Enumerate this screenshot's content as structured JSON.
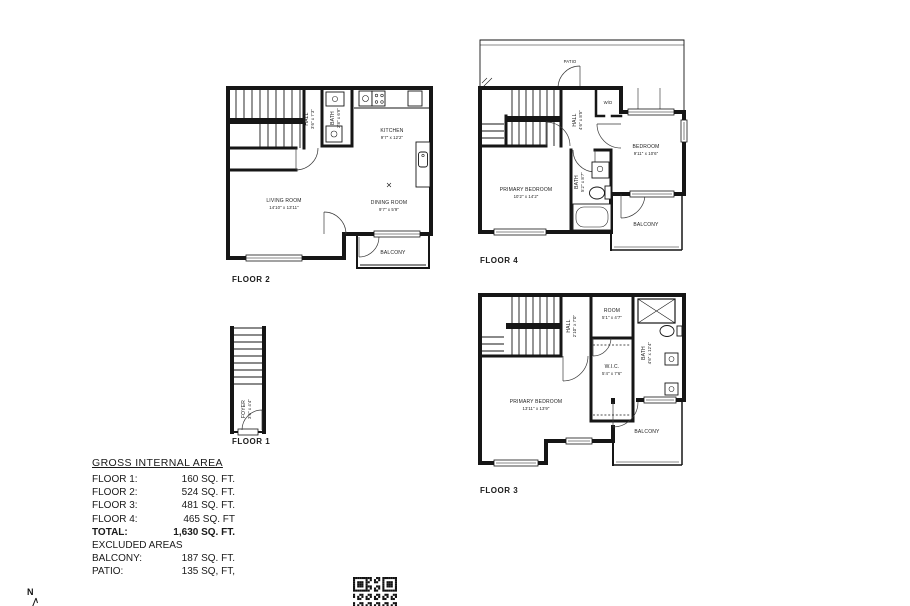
{
  "compass": {
    "label": "N"
  },
  "floors": {
    "floor1": {
      "label": "FLOOR 1",
      "rooms": {
        "foyer": {
          "name": "FOYER",
          "dims": "3'6\" x 4'4\""
        }
      }
    },
    "floor2": {
      "label": "FLOOR 2",
      "rooms": {
        "hall": {
          "name": "HALL",
          "dims": "3'6\" x 7'3\""
        },
        "bath": {
          "name": "BATH",
          "dims": "2'8\" x 6'9\""
        },
        "kitchen": {
          "name": "KITCHEN",
          "dims": "9'7\" x 12'2\""
        },
        "living_room": {
          "name": "LIVING ROOM",
          "dims": "14'10\" x 13'11\""
        },
        "dining_room": {
          "name": "DINING ROOM",
          "dims": "9'7\" x 5'9\""
        },
        "balcony": {
          "name": "BALCONY"
        }
      }
    },
    "floor3": {
      "label": "FLOOR 3",
      "rooms": {
        "hall": {
          "name": "HALL",
          "dims": "2'10\" x 7'0\""
        },
        "room": {
          "name": "ROOM",
          "dims": "5'1\" x 4'7\""
        },
        "bath": {
          "name": "BATH",
          "dims": "4'6\" x 12'4\""
        },
        "wic": {
          "name": "W.I.C.",
          "dims": "5'4\" x 7'6\""
        },
        "primary_bedroom": {
          "name": "PRIMARY BEDROOM",
          "dims": "13'11\" x 13'9\""
        },
        "balcony": {
          "name": "BALCONY"
        }
      }
    },
    "floor4": {
      "label": "FLOOR 4",
      "rooms": {
        "patio": {
          "name": "PATIO"
        },
        "hall": {
          "name": "HALL",
          "dims": "4'6\" x 8'5\""
        },
        "wd": {
          "name": "W/D"
        },
        "bedroom": {
          "name": "BEDROOM",
          "dims": "9'11\" x 10'6\""
        },
        "primary_bedroom": {
          "name": "PRIMARY BEDROOM",
          "dims": "10'2\" x 14'2\""
        },
        "bath": {
          "name": "BATH",
          "dims": "5'2\" x 8'7\""
        },
        "balcony": {
          "name": "BALCONY"
        }
      }
    }
  },
  "area_table": {
    "title": "GROSS INTERNAL AREA",
    "rows": [
      {
        "label": "FLOOR 1:",
        "value": "160 SQ. FT."
      },
      {
        "label": "FLOOR 2:",
        "value": "524 SQ. FT."
      },
      {
        "label": "FLOOR 3:",
        "value": "481 SQ. FT."
      },
      {
        "label": "FLOOR 4:",
        "value": "465 SQ. FT"
      },
      {
        "label": "TOTAL:",
        "value": "1,630 SQ. FT."
      }
    ],
    "excluded_title": "EXCLUDED AREAS",
    "excluded_rows": [
      {
        "label": "BALCONY:",
        "value": "187 SQ. FT."
      },
      {
        "label": "PATIO:",
        "value": "135 SQ, FT,"
      }
    ]
  }
}
